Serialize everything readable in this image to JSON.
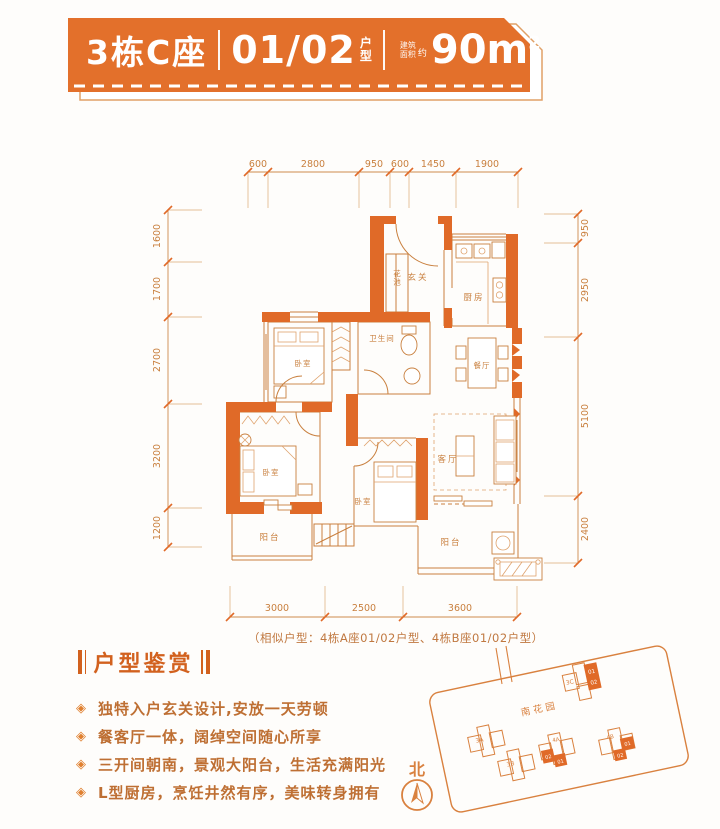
{
  "header": {
    "building": "3栋C座",
    "unit_number": "01/02",
    "unit_label_line1": "户",
    "unit_label_line2": "型",
    "area_label_line1": "建筑",
    "area_label_line2": "面积",
    "area_approx": "约",
    "area_value": "90m",
    "area_superscript": "2"
  },
  "floorplan": {
    "dims_top": [
      "600",
      "2800",
      "950",
      "600",
      "1450",
      "1900"
    ],
    "dims_left": [
      "1600",
      "1700",
      "2700",
      "3200",
      "1200"
    ],
    "dims_right": [
      "950",
      "2950",
      "5100",
      "2400"
    ],
    "dims_bottom": [
      "3000",
      "2500",
      "3600"
    ],
    "rooms": {
      "entry": "玄关",
      "planter": "花池",
      "kitchen": "厨房",
      "dining": "餐厅",
      "bathroom": "卫生间",
      "bedroom_mid": "卧室",
      "bedroom_left": "卧室",
      "bedroom_small": "卧室",
      "living": "客厅",
      "balcony_left": "阳台",
      "balcony_right": "阳台"
    },
    "similar_note": "（相似户型：4栋A座01/02户型、4栋B座01/02户型）"
  },
  "features": {
    "heading": "户型鉴赏",
    "bullet": "◈",
    "items": [
      "独特入户玄关设计,安放一天劳顿",
      "餐客厅一体，阔绰空间随心所享",
      "三开间朝南，景观大阳台，生活充满阳光",
      "L型厨房，烹饪井然有序，美味转身拥有"
    ]
  },
  "siteplan": {
    "garden": "南花园",
    "north": "北",
    "buildings": {
      "a3": "3A",
      "b3": "3B",
      "c3": "3C",
      "a4": "4A",
      "b4": "4B"
    },
    "highlight_units": {
      "u01": "01",
      "u02": "02"
    }
  },
  "colors": {
    "banner": "#E3702B",
    "wall": "#E06A28",
    "line": "#C9803F",
    "feature_text": "#BE6F33",
    "heading": "#D2611E"
  }
}
